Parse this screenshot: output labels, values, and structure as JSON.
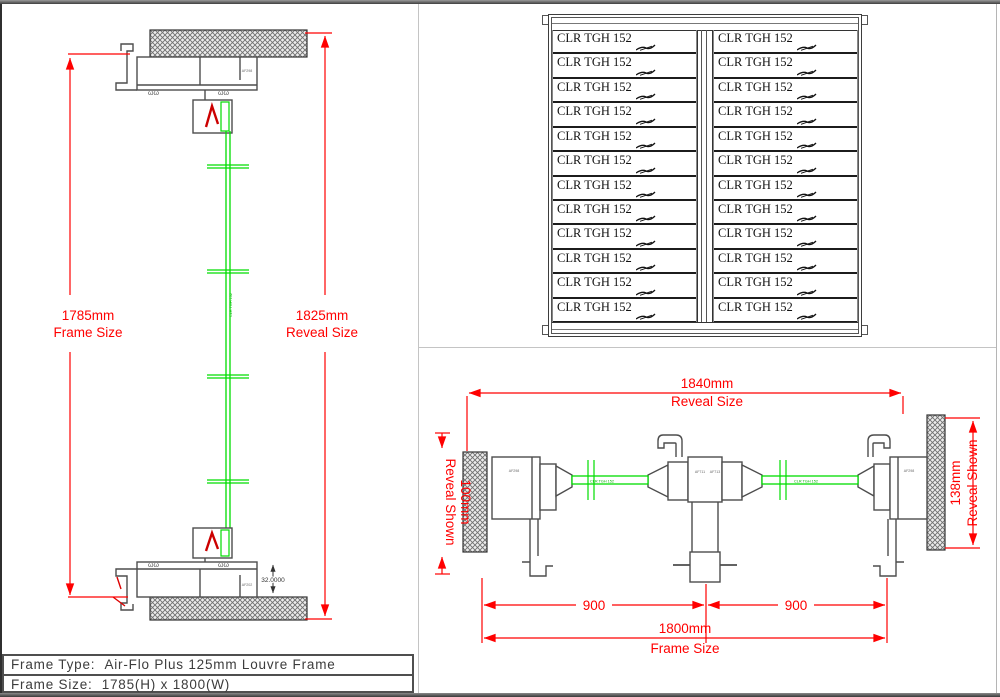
{
  "colors": {
    "dimension_red": "#ff0000",
    "louvre_green": "#00dd00",
    "profile_gray": "#4d4d4d"
  },
  "title_block": {
    "rows": [
      {
        "label": "Frame Type:",
        "value": "Air-Flo Plus 125mm Louvre Frame"
      },
      {
        "label": "Frame Size:",
        "value": "1785(H) x 1800(W)"
      }
    ]
  },
  "section_view": {
    "frame_dim_value": "1785mm",
    "frame_dim_label": "Frame Size",
    "reveal_dim_value": "1825mm",
    "reveal_dim_label": "Reveal Size",
    "sill_offset_dim": "32.0000",
    "head_profile_label": "AF298",
    "sill_profile_label": "AF202",
    "blade_text": "CLR TGH 152"
  },
  "elevation_view": {
    "slat_label": "CLR TGH 152",
    "rows_per_column": 12,
    "columns": 2
  },
  "plan_view": {
    "reveal_dim_value": "1840mm",
    "reveal_dim_label": "Reveal Size",
    "frame_dim_value": "1800mm",
    "frame_dim_label": "Frame Size",
    "left_reveal_value": "100mm",
    "left_reveal_label": "Reveal Shown",
    "right_reveal_value": "138mm",
    "right_reveal_label": "Reveal Shown",
    "bay_dims": [
      "900",
      "900"
    ],
    "blade_text": "CLR TGH 152",
    "profile_labels": [
      "AF298",
      "AF711",
      "AF713",
      "AF298"
    ]
  }
}
